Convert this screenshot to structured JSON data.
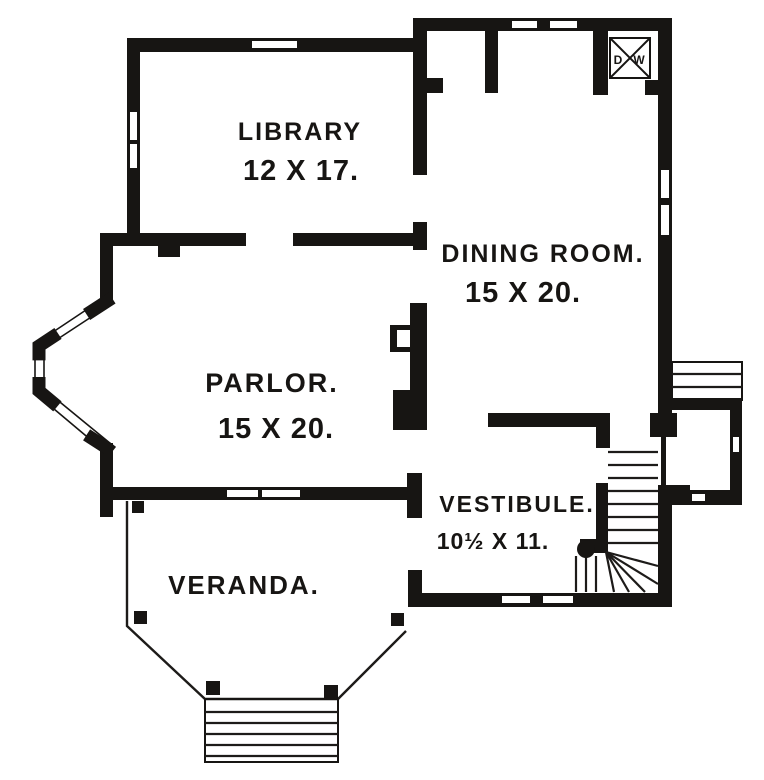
{
  "figure": {
    "type": "house-first-floor-plan"
  },
  "colors": {
    "ink": "#171513",
    "paper": "#ffffff"
  },
  "rooms": {
    "library": {
      "name": "LIBRARY",
      "dims": "12 X 17."
    },
    "dining": {
      "name": "DINING ROOM.",
      "dims": "15 X 20."
    },
    "parlor": {
      "name": "PARLOR.",
      "dims": "15 X 20."
    },
    "vestibule": {
      "name": "VESTIBULE.",
      "dims": "10½ X 11."
    },
    "veranda": {
      "name": "VERANDA."
    }
  },
  "dumbwaiter": {
    "d": "D",
    "w": "W"
  }
}
